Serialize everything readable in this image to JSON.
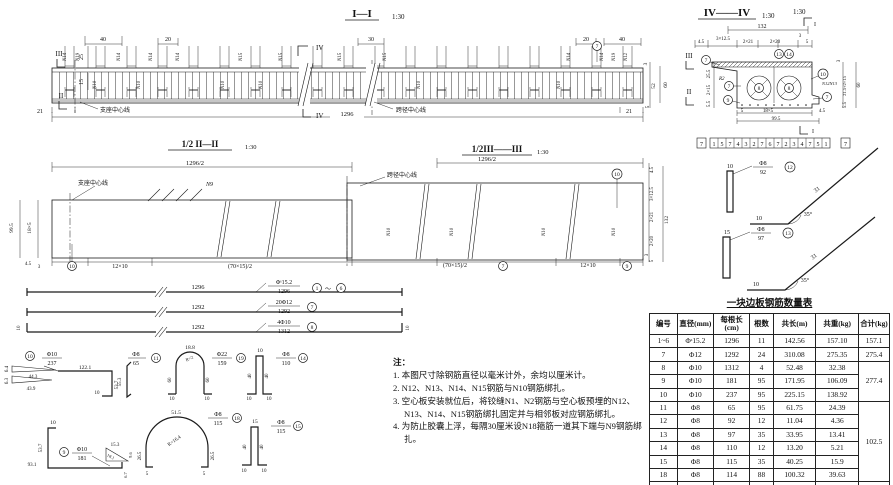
{
  "meta": {
    "ink": "#1b1b1b",
    "paper": "#ffffff"
  },
  "elev": {
    "title": "I—I",
    "scale": "1:30",
    "top_dims": {
      "d40l": "40",
      "d20l": "20",
      "d30": "30",
      "d20r": "20",
      "d40r": "40"
    },
    "left_dims": {
      "d25": "25",
      "d15": "15"
    },
    "right_dims": {
      "d3": "3",
      "d52": "52",
      "d60": "60",
      "d5": "5"
    },
    "bottom": {
      "d21l": "21",
      "cl_support": "支座中心线",
      "iv": "IV",
      "d1296": "1296",
      "cl_span": "跨径中心线",
      "d21r": "21"
    },
    "marks": {
      "iii_l": "III",
      "ii_l": "II",
      "iii_r": "III",
      "ii_r": "II",
      "iv_top": "IV"
    },
    "callout7": "7",
    "bars_top": [
      "N14",
      "N19",
      "N14",
      "N14",
      "N14",
      "N15",
      "N15",
      "N15",
      "N15",
      "N14",
      "N14",
      "N19",
      "N12"
    ],
    "bars_in": [
      "N10",
      "N10",
      "N10",
      "N10",
      "N10",
      "N10"
    ]
  },
  "xsec": {
    "title": "IV——IV",
    "scale": "1:30",
    "scale2": "1:30",
    "mark_top": "I",
    "mark_bot": "I",
    "dims_top": {
      "d132": "132",
      "d45": "4.5",
      "d3x125": "3×12.5",
      "d2x21": "2×21",
      "d2x20": "2×20",
      "d5": "5",
      "d3": "3"
    },
    "dims_left": {
      "d255": "25.5",
      "d2x15": "2×15",
      "d55": "5.5"
    },
    "dims_right": {
      "d3": "3",
      "dmid": "21.5+2×15",
      "d60": "60",
      "d55": "5.5"
    },
    "dims_bottom": {
      "d5": "5",
      "d18x5": "18×5",
      "d45": "4.5",
      "d995": "99.5"
    },
    "r2": "R2",
    "n1213": "N12N13",
    "callouts": {
      "c13": "13",
      "c14": "14",
      "c7a": "7",
      "c7b": "7",
      "c9": "9",
      "c8a": "8",
      "c8b": "8",
      "c10": "10",
      "c7c": "7"
    },
    "strip": [
      "7",
      "1",
      "5",
      "7",
      "4",
      "3",
      "2",
      "7",
      "6",
      "7",
      "2",
      "3",
      "4",
      "7",
      "5",
      "1",
      "7"
    ]
  },
  "plan": {
    "left_title": "1/2 II—II",
    "left_scale": "1:30",
    "right_title": "1/2III——III",
    "right_scale": "1:30",
    "half_l": "1296/2",
    "half_r": "1296/2",
    "cl_support": "支座中心线",
    "n9": "N9",
    "cl_span": "跨径中心线",
    "left_dims": {
      "d995": "99.5",
      "d18x5": "18×5",
      "d45": "4.5",
      "d3": "3"
    },
    "bottom": {
      "c10": "10",
      "d12x10l": "12×10",
      "d70l": "(70×15)/2",
      "d70r": "(70×15)/2",
      "c7": "7",
      "d12x10r": "12×10",
      "c9": "9"
    },
    "c10r": "10",
    "right_dims": {
      "d45": "4.5",
      "d3x125": "3×12.5",
      "d2x21": "2×21",
      "d2x20": "2×20",
      "d3": "3",
      "d5": "5",
      "d132": "132"
    },
    "n10s": [
      "N10",
      "N10",
      "N10",
      "N10"
    ]
  },
  "bars": [
    {
      "dim": "1296",
      "spec": "Φˢ15.2",
      "len": "1296",
      "id_from": "1",
      "tilde": "～",
      "id_to": "6"
    },
    {
      "dim": "1292",
      "spec": "20Φ12",
      "len": "1292",
      "id": "7"
    },
    {
      "dim": "1292",
      "spec": "4Φ10",
      "len": "1312",
      "id": "8",
      "hook_l": "10",
      "hook_r": "10"
    }
  ],
  "bent": {
    "b10": {
      "id": "10",
      "spec": "Φ10",
      "len": "237",
      "d64": "6.4",
      "d443": "44.3",
      "d63": "6.3",
      "d439": "43.9",
      "d1221": "122.1",
      "d537": "53.7",
      "d10": "10"
    },
    "b11": {
      "id": "11",
      "spec": "Φ8",
      "len": "65",
      "d553": "55.3"
    },
    "b19": {
      "id": "19",
      "spec": "Φ22",
      "len": "159",
      "arc": "18.8",
      "r": "R=2",
      "l1": "60",
      "l2": "60",
      "f1": "10",
      "f2": "10"
    },
    "b14": {
      "id": "14",
      "spec": "Φ8",
      "len": "110",
      "top": "10",
      "l1": "40",
      "l2": "40",
      "f1": "10",
      "f2": "10"
    },
    "b9": {
      "id": "9",
      "spec": "Φ10",
      "len": "181",
      "top": "10",
      "d537": "53.7",
      "d931": "93.1",
      "d153": "15.3",
      "d181": "18.1",
      "d96": "9.6",
      "d67": "6.7"
    },
    "b18": {
      "id": "18",
      "spec": "Φ8",
      "len": "115",
      "arc": "51.5",
      "r": "R=16.4",
      "l1": "26.5",
      "l2": "26.5",
      "f1": "5",
      "f2": "5"
    },
    "b15": {
      "id": "15",
      "spec": "Φ8",
      "len": "115",
      "top": "15",
      "l1": "40",
      "l2": "40",
      "f1": "10",
      "f2": "10"
    },
    "b12": {
      "id": "12",
      "spec": "Φ8",
      "len": "92",
      "top": "10",
      "diag": "31",
      "bot": "10",
      "ang": "35°"
    },
    "b13": {
      "id": "13",
      "spec": "Φ8",
      "len": "97",
      "top": "15",
      "diag": "31",
      "bot": "10",
      "ang": "35°"
    }
  },
  "notes": {
    "head": "注：",
    "items": [
      "1. 本图尺寸除钢筋直径以毫米计外，余均以厘米计。",
      "2. N12、N13、N14、N15钢筋与N10钢筋绑扎。",
      "3. 空心板安装就位后，将铰缝N1、N2钢筋与空心板预埋的N12、N13、N14、N15钢筋绑扎固定并与相邻板对应钢筋绑扎。",
      "4. 为防止胶囊上浮，每隔30厘米设N18箍筋一道其下端与N9钢筋绑扎。"
    ]
  },
  "table": {
    "title": "一块边板钢筋数量表",
    "headers": [
      "编号",
      "直径(mm)",
      "每根长(cm)",
      "根数",
      "共长(m)",
      "共重(kg)",
      "合计(kg)"
    ],
    "rows": [
      [
        "1~6",
        "Φˢ15.2",
        "1296",
        "11",
        "142.56",
        "157.10"
      ],
      [
        "7",
        "Φ12",
        "1292",
        "24",
        "310.08",
        "275.35"
      ],
      [
        "8",
        "Φ10",
        "1312",
        "4",
        "52.48",
        "32.38"
      ],
      [
        "9",
        "Φ10",
        "181",
        "95",
        "171.95",
        "106.09"
      ],
      [
        "10",
        "Φ10",
        "237",
        "95",
        "225.15",
        "138.92"
      ],
      [
        "11",
        "Φ8",
        "65",
        "95",
        "61.75",
        "24.39"
      ],
      [
        "12",
        "Φ8",
        "92",
        "12",
        "11.04",
        "4.36"
      ],
      [
        "13",
        "Φ8",
        "97",
        "35",
        "33.95",
        "13.41"
      ],
      [
        "14",
        "Φ8",
        "110",
        "12",
        "13.20",
        "5.21"
      ],
      [
        "15",
        "Φ8",
        "115",
        "35",
        "40.25",
        "15.9"
      ],
      [
        "18",
        "Φ8",
        "114",
        "88",
        "100.32",
        "39.63"
      ],
      [
        "19",
        "Φ22",
        "159",
        "4",
        "6.36",
        "18.95"
      ]
    ],
    "totals": {
      "t1": "157.1",
      "t2": "275.4",
      "t3": "277.4",
      "t4": "102.5",
      "t5": "19.0"
    }
  }
}
